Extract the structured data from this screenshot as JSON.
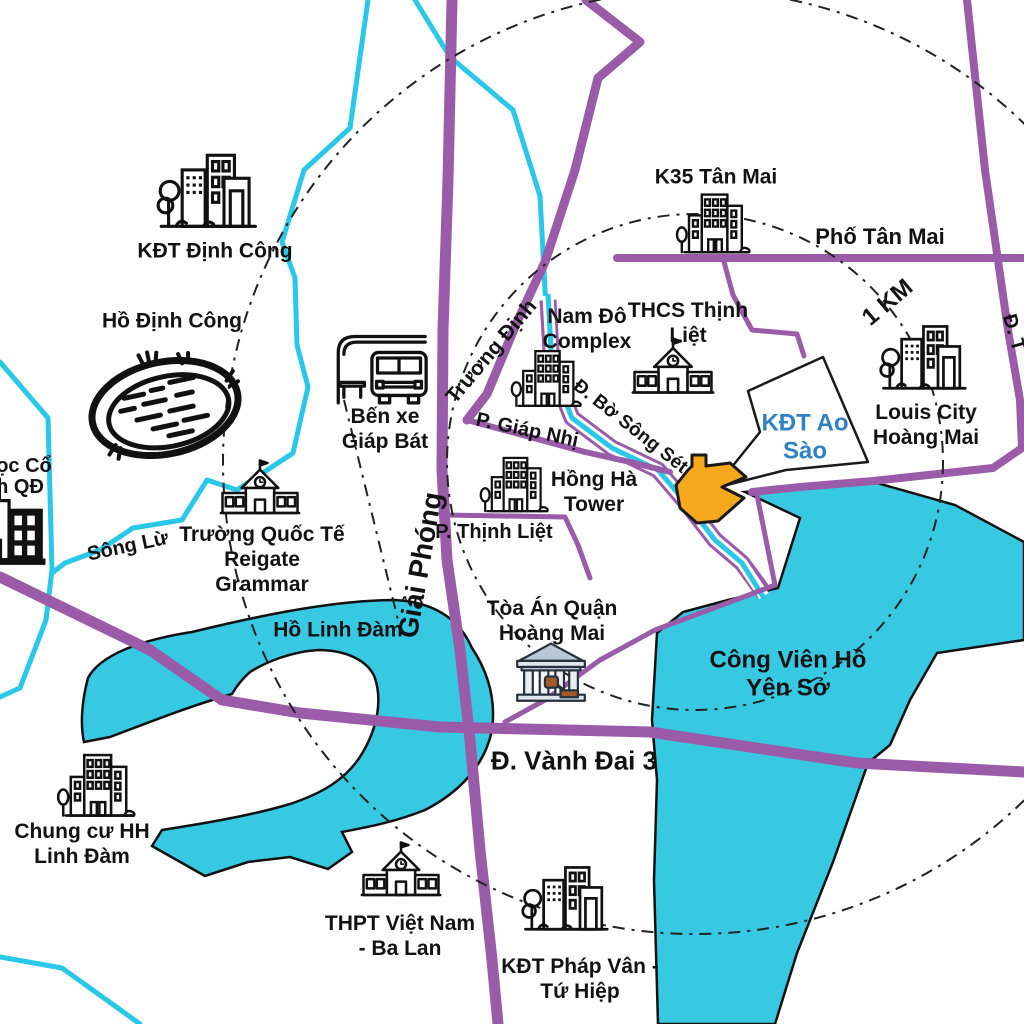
{
  "marker": {
    "name": "project-location-arrow",
    "label_line1": "KĐT Ao",
    "label_line2": "Sào",
    "arrow_color": "#F5A81C",
    "label_color": "#2F80C4"
  },
  "rings": {
    "inner_label": "1 KM"
  },
  "roads": {
    "color": "#9A5BA8",
    "giai_phong": "Giải Phóng",
    "truong_dinh": "Trương Định",
    "pho_tan_mai": "Phố Tân Mai",
    "p_giap_nhi": "P. Giáp Nhị",
    "p_thinh_liet": "P. Thịnh Liệt",
    "d_bo_song_set": "Đ. Bờ Sông Sét",
    "d_vanh_dai_3": "Đ. Vành Đai 3",
    "d_edge_partial": "Đ. T"
  },
  "waterways": {
    "color": "#29C7E8",
    "song_lu": "Sông Lừ"
  },
  "lakes": {
    "fill": "#38C9E2",
    "ho_dinh_cong": "Hồ Định Công",
    "ho_linh_dam": "Hồ Linh Đàm",
    "cong_vien_line1": "Công Viên Hồ",
    "cong_vien_line2": "Yên Sở"
  },
  "landmarks": {
    "kdt_dinh_cong": "KĐT Định Công",
    "ben_xe_line1": "Bến xe",
    "ben_xe_line2": "Giáp Bát",
    "truong_qt_line1": "Trường Quốc Tế",
    "truong_qt_line2": "Reigate",
    "truong_qt_line3": "Grammar",
    "hospital_frag_line1": "ọc Cổ",
    "hospital_frag_line2": "n QĐ",
    "nam_do_line1": "Nam Đô",
    "nam_do_line2": "Complex",
    "thcs_line1": "THCS Thịnh",
    "thcs_line2": "Liệt",
    "k35": "K35 Tân Mai",
    "louis_line1": "Louis City",
    "louis_line2": "Hoàng Mai",
    "hong_ha_line1": "Hồng Hà",
    "hong_ha_line2": "Tower",
    "toa_an_line1": "Tòa Án Quận",
    "toa_an_line2": "Hoàng Mai",
    "chung_cu_line1": "Chung cư HH",
    "chung_cu_line2": "Linh Đàm",
    "thpt_line1": "THPT Việt Nam",
    "thpt_line2": "- Ba Lan",
    "phap_van_line1": "KĐT Pháp Vân -",
    "phap_van_line2": "Tứ Hiệp"
  }
}
